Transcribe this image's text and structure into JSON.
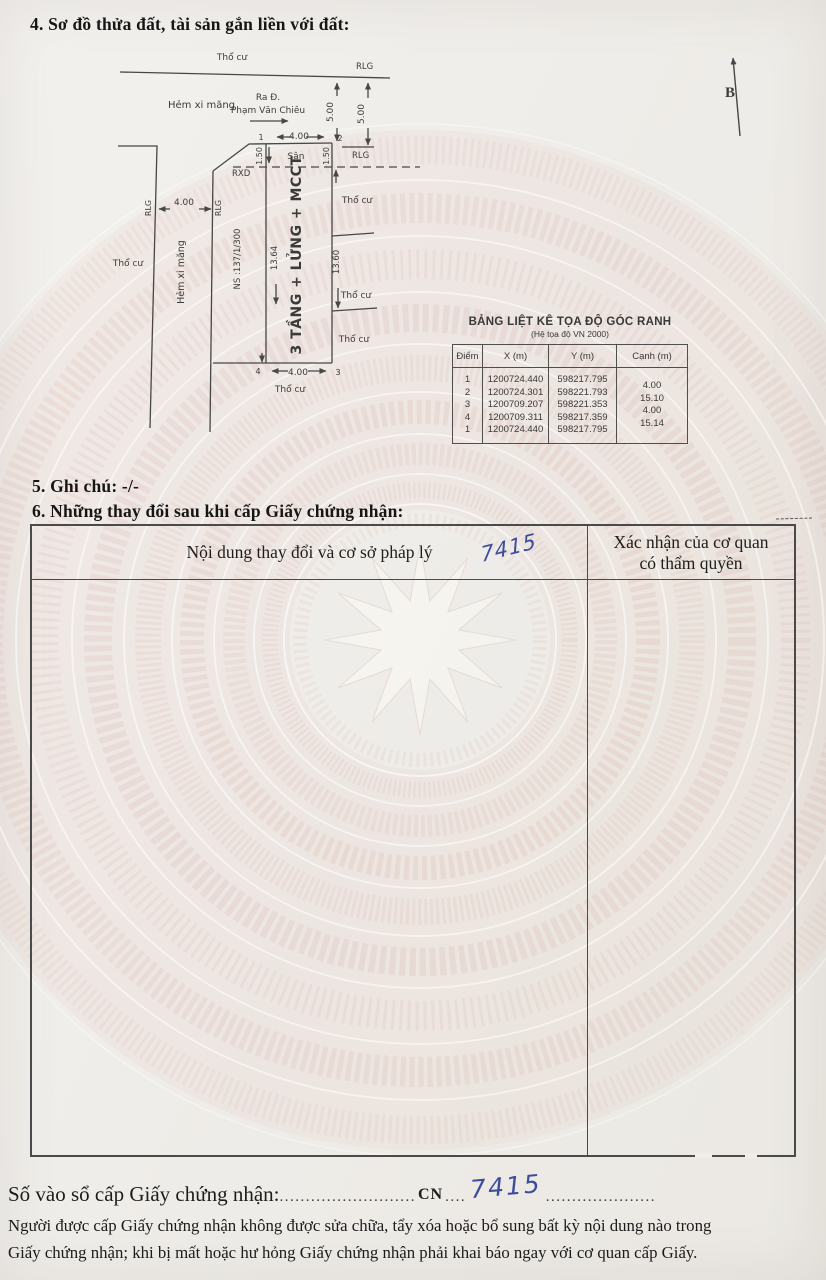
{
  "section4": {
    "title": "4. Sơ đồ thửa đất, tài sản gắn liền với đất:"
  },
  "diagram": {
    "north": "B",
    "tho_cu": "Thổ cư",
    "rlg": "RLG",
    "rxd": "RXD",
    "san": "Sân",
    "hem_xi_mang": "Hẻm xi măng",
    "ra_d": "Ra Đ.",
    "street_name": "Phạm Văn Chiêu",
    "house_no": "NS :137/1/300",
    "building": "3 TẦNG + LỬNG + MCCT",
    "dim_5_00": "5.00",
    "dim_4_00": "4.00",
    "dim_1_50": "1.50",
    "dim_13_64": "13.64",
    "dim_13_60": "13.60",
    "pt1": "1",
    "pt2": "2",
    "pt3": "3",
    "pt4": "4"
  },
  "coord_table": {
    "title": "BẢNG LIỆT KÊ TỌA ĐỘ GÓC RANH",
    "subtitle": "(Hệ tọa độ VN 2000)",
    "headers": [
      "Điểm",
      "X (m)",
      "Y (m)",
      "Cạnh (m)"
    ],
    "points": [
      {
        "id": "1",
        "x": "1200724.440",
        "y": "598217.795"
      },
      {
        "id": "2",
        "x": "1200724.301",
        "y": "598221.793"
      },
      {
        "id": "3",
        "x": "1200709.207",
        "y": "598221.353"
      },
      {
        "id": "4",
        "x": "1200709.311",
        "y": "598217.359"
      },
      {
        "id": "1",
        "x": "1200724.440",
        "y": "598217.795"
      }
    ],
    "edges": [
      "4.00",
      "15.10",
      "4.00",
      "15.14"
    ]
  },
  "section5": {
    "text": "5. Ghi chú: -/-"
  },
  "section6": {
    "title": "6. Những thay đổi sau khi cấp Giấy chứng nhận:",
    "col1_header": "Nội dung thay đổi và cơ sở pháp lý",
    "col2_header_line1": "Xác nhận của cơ quan",
    "col2_header_line2": "có thẩm quyền",
    "handwritten_note": "7415"
  },
  "serial": {
    "label": "Số vào sổ cấp Giấy chứng nhận:",
    "dots_1": "..........................",
    "prefix": "CN",
    "dots_2": "....",
    "number": "7415",
    "dots_3": "....................."
  },
  "footer": {
    "line1": "Người được cấp Giấy chứng nhận không được sửa chữa, tẩy xóa hoặc bổ sung bất kỳ nội dung nào trong",
    "line2": "Giấy chứng nhận; khi bị mất hoặc hư hỏng Giấy chứng nhận phải khai báo ngay với cơ quan cấp Giấy."
  }
}
